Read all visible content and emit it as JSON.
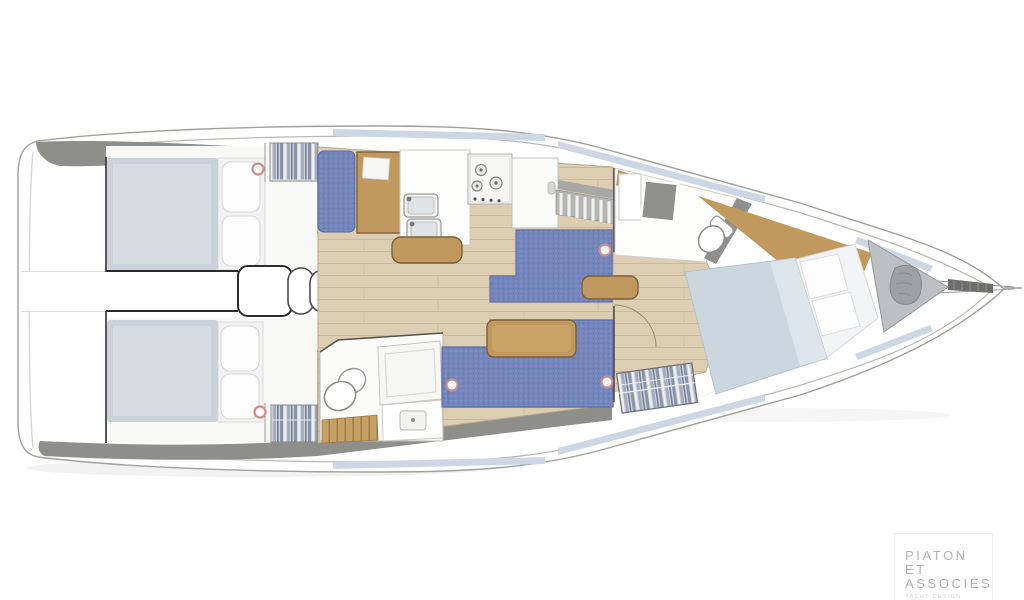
{
  "logo": {
    "line1": "PIATON",
    "line2": "ET",
    "line3": "ASSOCIÉS",
    "tagline": "YACHT DESIGN"
  },
  "colors": {
    "background": "#ffffff",
    "hull_outline": "#a0a09c",
    "deck_gray": "#8e8e8a",
    "window_blue": "#cdd7e3",
    "floor_wood": "#dccdb3",
    "wood_furniture": "#c1995f",
    "settee_blue": "#7486bc",
    "bed_gray": "#cbd1d8",
    "bed_forward_gray": "#ccd6de",
    "pillow_white": "#f7f8f9",
    "locker_gray": "#bcc0c3",
    "fixture_gray": "#8f8f8d",
    "accent_ring": "#c98f8f",
    "logo_text": "#b3b3b3",
    "logo_tagline": "#d6d6d6"
  }
}
